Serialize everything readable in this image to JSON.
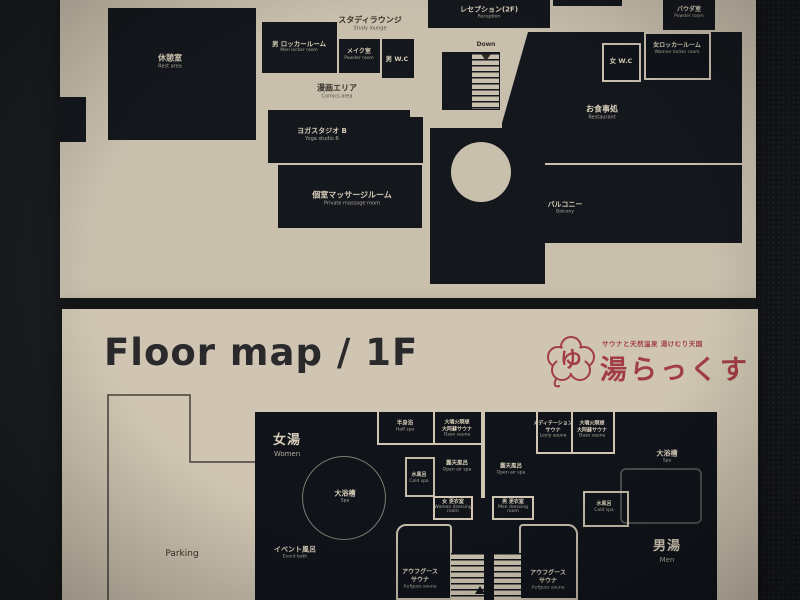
{
  "boards": {
    "f2": {
      "rooms": {
        "rest": {
          "jp": "休憩室",
          "en": "Rest area"
        },
        "study": {
          "jp": "スタディラウンジ",
          "en": "Study lounge"
        },
        "men_locker": {
          "jp": "男 ロッカールーム",
          "en": "Men locker room"
        },
        "makeup": {
          "jp": "メイク室",
          "en": "Powder room"
        },
        "men_wc": {
          "jp": "男 W.C"
        },
        "reception": {
          "jp": "レセプション(2F)",
          "en": "Reception"
        },
        "down": {
          "en": "Down"
        },
        "powder": {
          "jp": "パウダ室",
          "en": "Powder room"
        },
        "women_wc": {
          "jp": "女 W.C"
        },
        "women_locker": {
          "jp": "女ロッカールーム",
          "en": "Women locker room"
        },
        "comics": {
          "jp": "漫画エリア",
          "en": "Comics area"
        },
        "yoga": {
          "jp": "ヨガスタジオ B",
          "en": "Yoga studio B"
        },
        "massage": {
          "jp": "個室マッサージルーム",
          "en": "Private massage room"
        },
        "restaurant": {
          "jp": "お食事処",
          "en": "Restaurant"
        },
        "balcony": {
          "jp": "バルコニー",
          "en": "Balcony"
        }
      }
    },
    "f1": {
      "title": "Floor map / 1F",
      "logo": {
        "mark": "ゆ",
        "tagline": "サウナと天然温泉 湯けむり天国",
        "name": "湯らっくす",
        "color": "#a23d45"
      },
      "rooms": {
        "women_bath": {
          "jp": "女湯",
          "en": "Women"
        },
        "men_bath": {
          "jp": "男湯",
          "en": "Men"
        },
        "half_spa": {
          "jp": "半身浴",
          "en": "Half spa"
        },
        "oaso": {
          "jp": "大噴火瞑想",
          "jp2": "大阿蘇サウナ",
          "en": "Oaso sauna"
        },
        "meditation": {
          "jp": "メディテーション",
          "jp2": "サウナ",
          "en": "Loyly sauna"
        },
        "open_air": {
          "jp": "露天風呂",
          "en": "Open air spa"
        },
        "cold": {
          "jp": "水風呂",
          "en": "Cold spa"
        },
        "spa": {
          "jp": "大浴槽",
          "en": "Spa"
        },
        "women_dress": {
          "jp": "女 更衣室",
          "en": "Women dressing room"
        },
        "men_dress": {
          "jp": "男 更衣室",
          "en": "Men dressing room"
        },
        "event": {
          "jp": "イベント風呂",
          "en": "Event bath"
        },
        "aufguss": {
          "jp": "アウフグース",
          "jp2": "サウナ",
          "en": "Aufguss sauna"
        },
        "parking": {
          "en": "Parking"
        }
      }
    }
  }
}
